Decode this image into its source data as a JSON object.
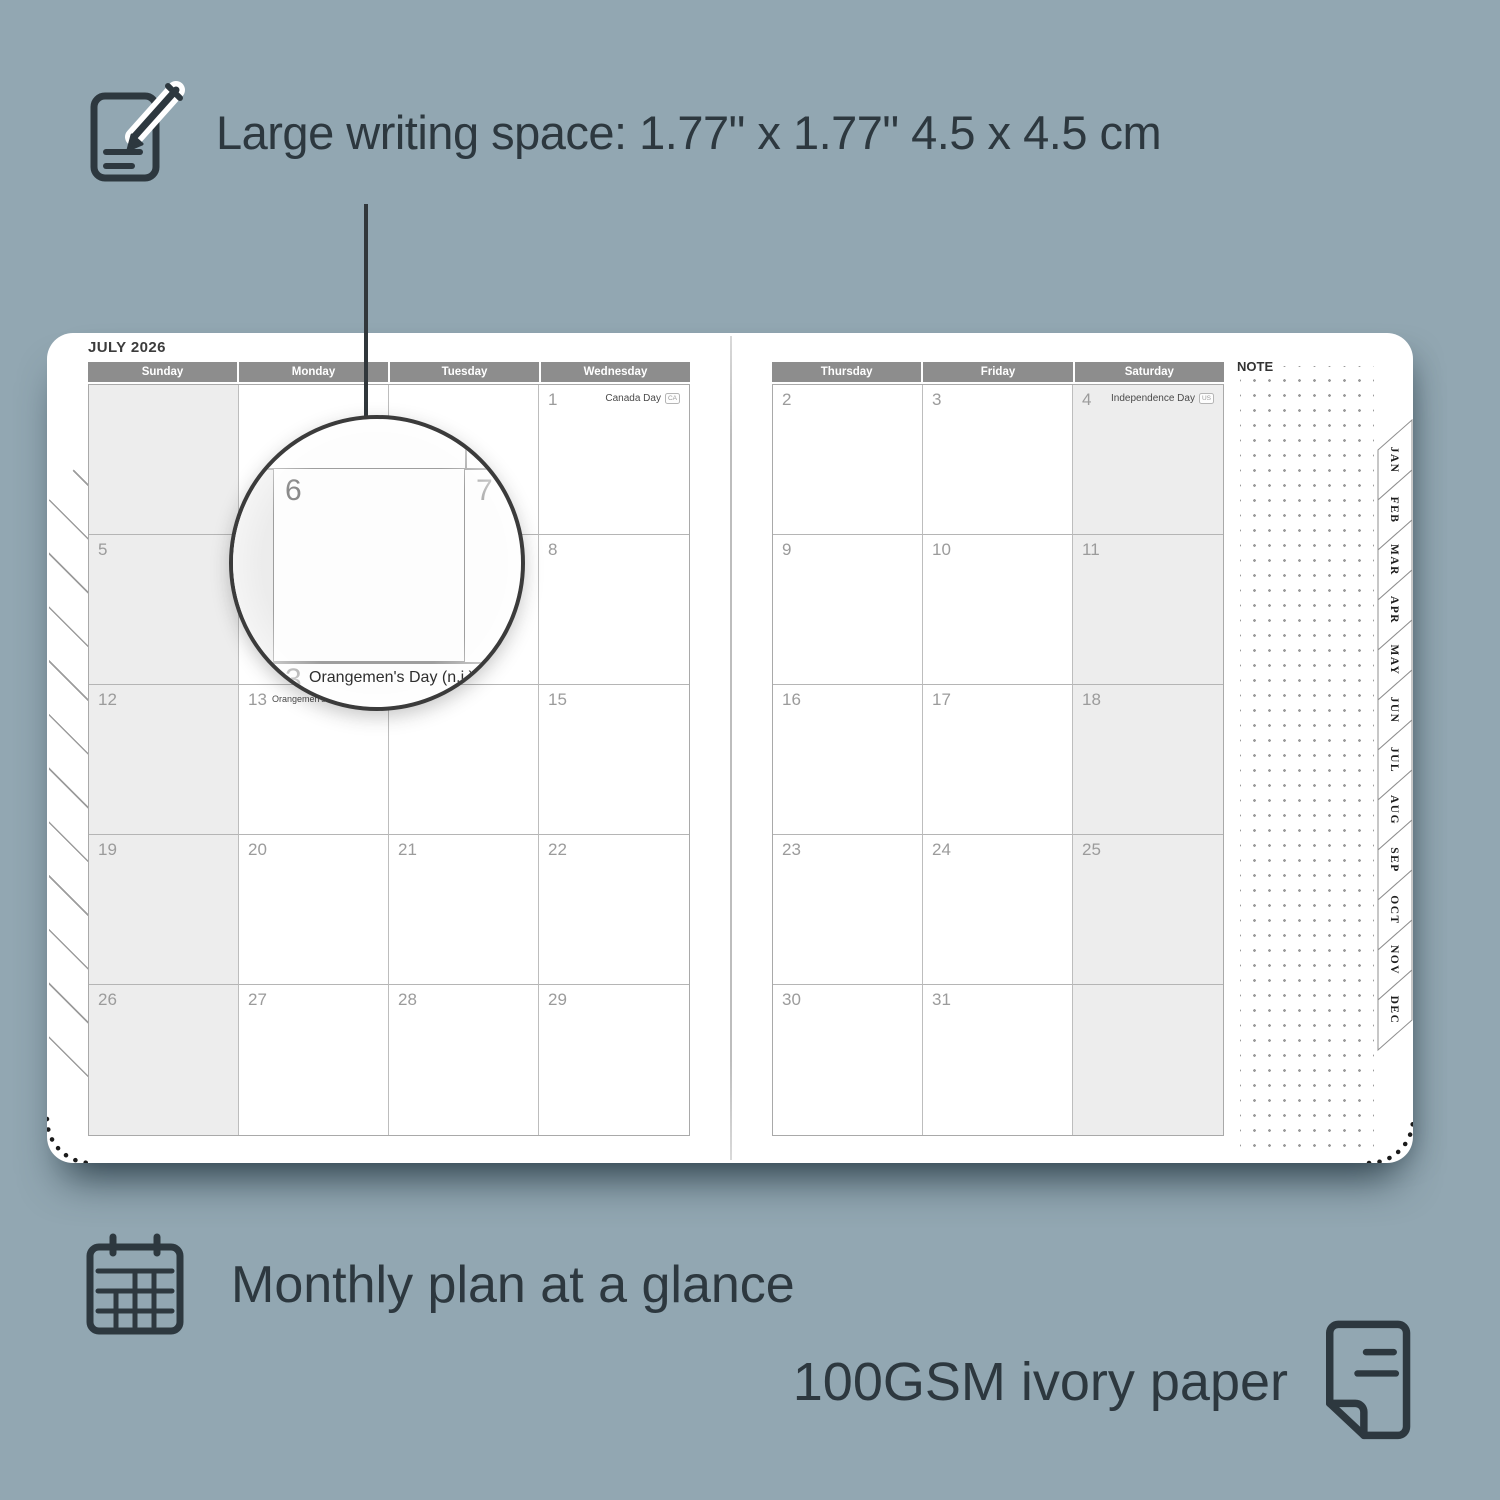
{
  "colors": {
    "background": "#92a7b2",
    "ink": "#2d383f",
    "header_gray": "#8d8d8d",
    "weekend_shade": "#ededed",
    "grid_line": "#b6b6b6",
    "date_number": "#9b9b9b",
    "magnifier_ring": "#3b3b3b",
    "paper": "#ffffff"
  },
  "features": {
    "writing_space": {
      "icon": "notepad-pencil-icon",
      "label": "Large writing space: 1.77\" x 1.77\" 4.5 x 4.5 cm"
    },
    "monthly": {
      "icon": "calendar-grid-icon",
      "label": "Monthly plan at a glance"
    },
    "paper": {
      "icon": "paper-sheet-icon",
      "label": "100GSM ivory paper"
    }
  },
  "planner": {
    "title": "JULY 2026",
    "note_label": "NOTE",
    "weekday_headers_left": [
      "Sunday",
      "Monday",
      "Tuesday",
      "Wednesday"
    ],
    "weekday_headers_right": [
      "Thursday",
      "Friday",
      "Saturday"
    ],
    "month_tabs": [
      "JAN",
      "FEB",
      "MAR",
      "APR",
      "MAY",
      "JUN",
      "JUL",
      "AUG",
      "SEP",
      "OCT",
      "NOV",
      "DEC"
    ],
    "weeks_left": [
      [
        "",
        "",
        "",
        {
          "day": "1",
          "holiday": "Canada Day",
          "flag": "CA"
        }
      ],
      [
        "5",
        "6",
        "7",
        "8"
      ],
      [
        "12",
        {
          "day": "13",
          "holiday": "Orangemen's Day (n.i.)",
          "flag": "UK",
          "inline": true
        },
        "14",
        "15"
      ],
      [
        "19",
        "20",
        "21",
        "22"
      ],
      [
        "26",
        "27",
        "28",
        "29"
      ]
    ],
    "weeks_right": [
      [
        "2",
        "3",
        {
          "day": "4",
          "holiday": "Independence Day",
          "flag": "US"
        }
      ],
      [
        "9",
        "10",
        "11"
      ],
      [
        "16",
        "17",
        "18"
      ],
      [
        "23",
        "24",
        "25"
      ],
      [
        "30",
        "31",
        ""
      ]
    ]
  },
  "magnifier": {
    "day_primary": "6",
    "day_secondary": "7",
    "day_partial": "3",
    "holiday": "Orangemen's Day (n.i.)",
    "flag": "UK"
  }
}
